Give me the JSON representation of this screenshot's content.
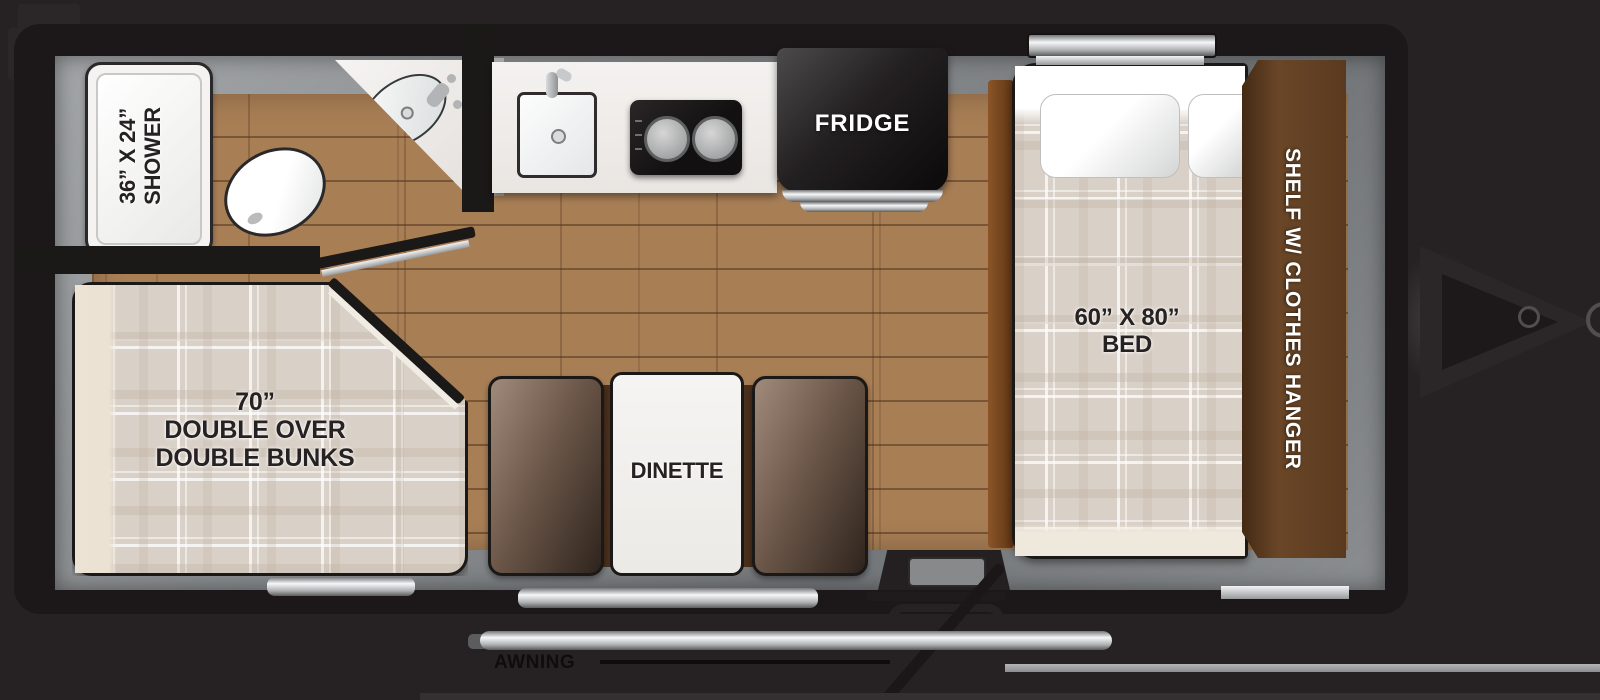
{
  "title": "Travel trailer floor plan",
  "rooms": {
    "bathroom": {
      "shower_label_line1": "36” X 24”",
      "shower_label_line2": "SHOWER"
    },
    "bunk_room": {
      "bunk_label_line1": "70”",
      "bunk_label_line2": "DOUBLE OVER",
      "bunk_label_line3": "DOUBLE BUNKS"
    },
    "kitchen": {
      "fridge_label": "FRIDGE"
    },
    "dinette": {
      "table_label": "DINETTE"
    },
    "bedroom": {
      "bed_label_line1": "60” X 80”",
      "bed_label_line2": "BED",
      "shelf_label": "SHELF W/ CLOTHES HANGER"
    },
    "exterior": {
      "awning_label": "AWNING"
    }
  },
  "colors": {
    "background": "#262223",
    "shell_black": "#1c1819",
    "wall_gray": "#8b8e90",
    "floor_wood": "#a87e55",
    "counter_white": "#f2f0ed",
    "mattress_plaid": "#d9d0c7",
    "shelf_brown": "#5a3a1f",
    "bench_brown": "#6d584a",
    "appliance_black": "#141112",
    "accent_silver": "#c9cbcd",
    "label_dark": "#262122",
    "label_light": "#ffffff"
  }
}
